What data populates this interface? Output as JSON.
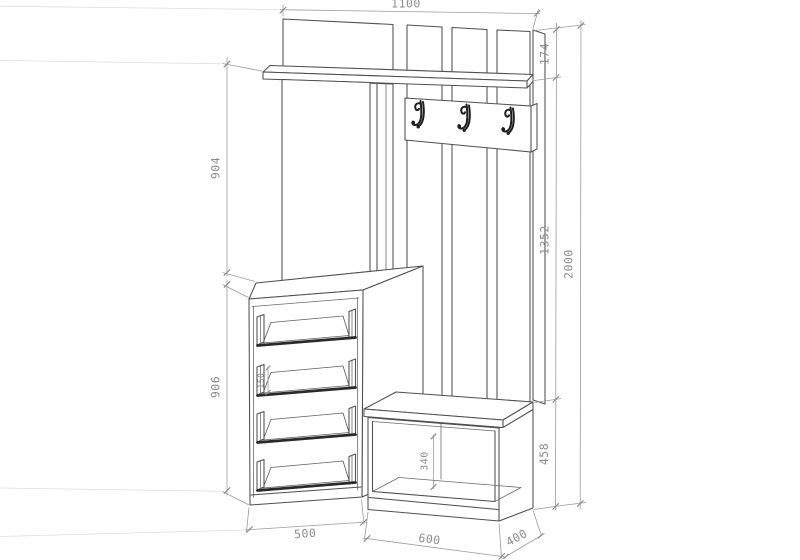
{
  "drawing": {
    "kind": "furniture-technical-drawing",
    "subject": "hallway unit with top rail, hat shelf, coat hook panel, mirror, 4-drawer cabinet and bench",
    "background": "#ffffff",
    "line_color": "#4f4f4f",
    "dimension_line_color": "#9c9c9c",
    "label_color": "#8c8c8c",
    "hook_count": 3,
    "drawer_count": 4
  },
  "dimensions": {
    "overall_width": "1100",
    "top_rail_height": "174",
    "shelf_to_cabinet": "904",
    "mid_section_height": "1352",
    "overall_height": "2000",
    "cabinet_height": "906",
    "drawer_side_height": "150",
    "bench_inner_height": "340",
    "bench_height": "458",
    "cabinet_width": "500",
    "bench_width": "600",
    "bench_depth": "400"
  }
}
